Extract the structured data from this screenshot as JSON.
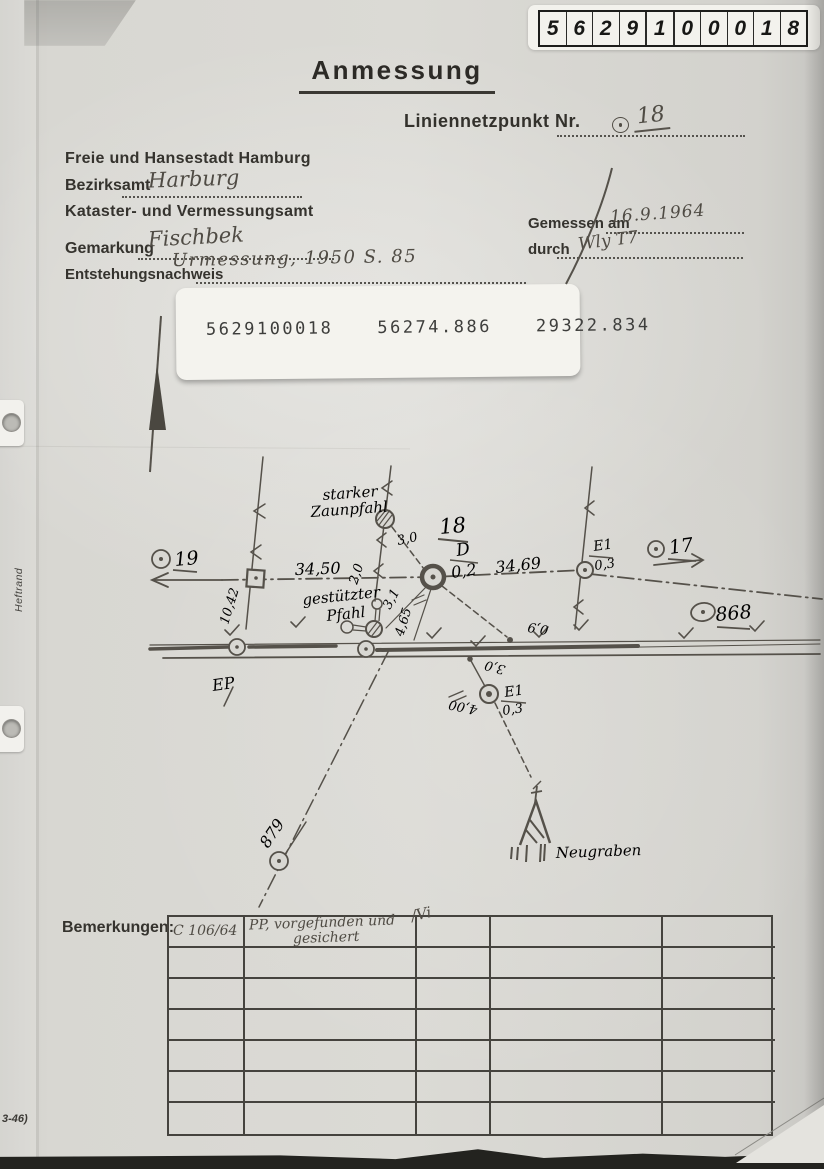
{
  "id_box": {
    "digits": [
      "5",
      "6",
      "2",
      "9",
      "1",
      "0",
      "0",
      "0",
      "1",
      "8"
    ]
  },
  "header": {
    "title": "Anmessung",
    "point_label": "Liniennetzpunkt Nr.",
    "point_number": "18",
    "authority": "Freie und Hansestadt Hamburg",
    "bezirksamt_label": "Bezirksamt",
    "bezirksamt_value": "Harburg",
    "office": "Kataster- und Vermessungsamt",
    "gemarkung_label": "Gemarkung",
    "gemarkung_value": "Fischbek",
    "entstehung_label": "Entstehungsnachweis",
    "entstehung_value": "Urmessung, 1950 S. 85",
    "gemessen_label": "Gemessen am",
    "gemessen_value": "16.9.1964",
    "durch_label": "durch",
    "durch_value": "Wly T7"
  },
  "sticker": {
    "point_id": "5629100018",
    "coord_x": "56274.886",
    "coord_y": "29322.834"
  },
  "sketch": {
    "zaunpfahl_line1": "starker",
    "zaunpfahl_line2": "Zaunpfahl",
    "gestuetzt_line1": "gestützter",
    "gestuetzt_line2": "Pfahl",
    "point18": "18",
    "d_label": "D",
    "d_value": "0,2",
    "dist_left": "34,50",
    "dist_right": "34,69",
    "dist_1042": "10,42",
    "tie_30": "3,0",
    "tie_20": "2,0",
    "tie_31": "3,1",
    "tie_465": "4,65",
    "tie_09": "0,9",
    "pt19": "19",
    "pt17": "17",
    "pt868": "868",
    "pt879": "879",
    "e1_label": "E1",
    "e1_value": "0,3",
    "e1b_label": "E1",
    "e1b_value": "0,3",
    "low_30": "3,0",
    "low_400": "4,00",
    "ep": "EP",
    "neugraben": "Neugraben"
  },
  "remarks": {
    "label": "Bemerkungen:",
    "row1": {
      "col1": "C 106/64",
      "line1": "PP, vorgefunden und",
      "line2": "gesichert",
      "sig": "/Vi"
    }
  },
  "footer": {
    "form_number": "3-46)",
    "margin_label": "Heftrand"
  }
}
